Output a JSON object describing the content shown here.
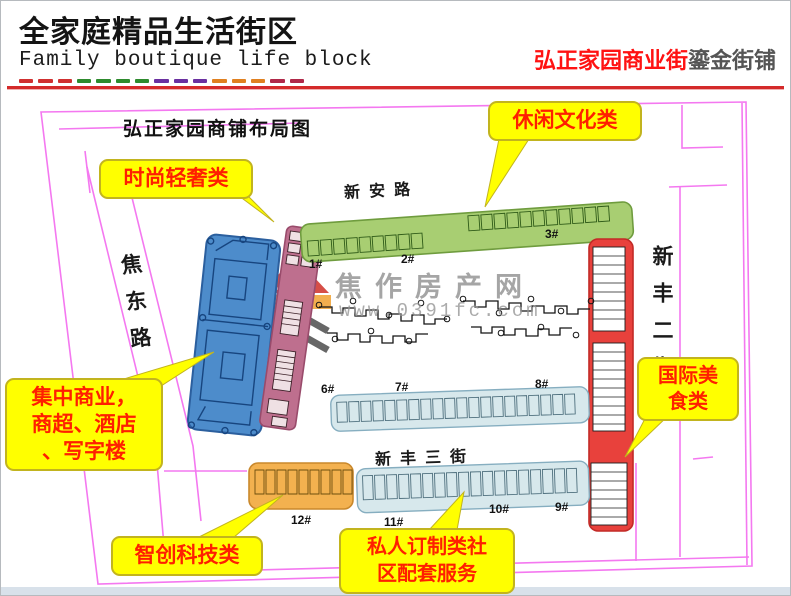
{
  "header": {
    "title": "全家庭精品生活街区",
    "subtitle": "Family boutique life block",
    "brand_red": "弘正家园商业街",
    "brand_gray": "鎏金街铺"
  },
  "map": {
    "title": "弘正家园商铺布局图",
    "streets": {
      "north": "新安路",
      "west": "焦东路",
      "east": "新丰二街",
      "south": "新丰三街"
    },
    "buildings": {
      "b1": "1#",
      "b2": "2#",
      "b3": "3#",
      "b6": "6#",
      "b7": "7#",
      "b8": "8#",
      "b9": "9#",
      "b10": "10#",
      "b11": "11#",
      "b12": "12#"
    },
    "callouts": {
      "fashion": "时尚轻奢类",
      "leisure": "休闲文化类",
      "central_line1": "集中商业，",
      "central_line2": "商超、酒店",
      "central_line3": "、写字楼",
      "food_line1": "国际美",
      "food_line2": "食类",
      "tech": "智创科技类",
      "private_line1": "私人订制类社",
      "private_line2": "区配套服务"
    },
    "watermark": {
      "name": "焦作房产网",
      "url": "www.0391fc.com"
    }
  },
  "colors": {
    "header_rule_red": "#d42a2a",
    "brand_red": "#ff1212",
    "callout_yellow": "#ffff00",
    "callout_text_red": "#ff1f00",
    "plan_border_pink": "#f478f0",
    "zone_green": "#a8ce72",
    "zone_mauve": "#be6f8e",
    "zone_blue": "#4d8ccb",
    "zone_red": "#e8413c",
    "zone_lightblue": "#d7e8ec",
    "zone_orange": "#f3b14f"
  }
}
